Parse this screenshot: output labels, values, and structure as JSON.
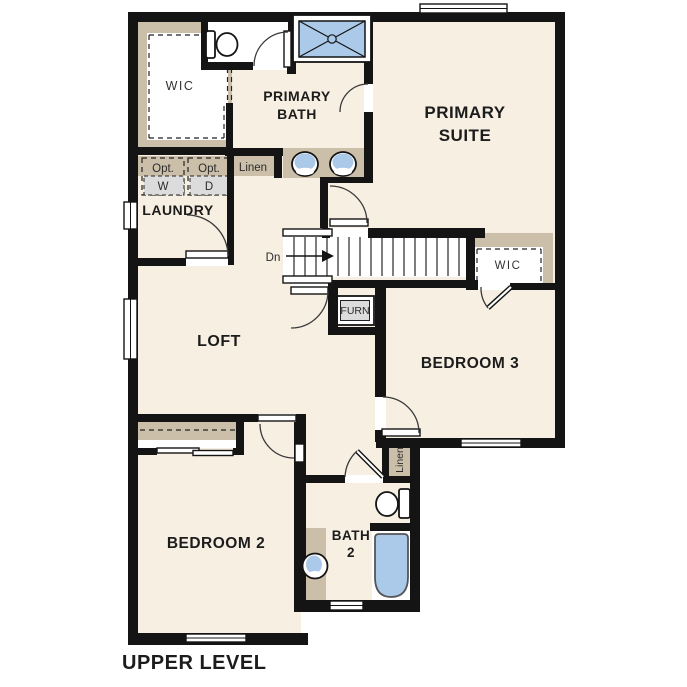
{
  "title": "UPPER LEVEL",
  "colors": {
    "wall": "#141414",
    "floor": "#f7efe2",
    "cabinet_tan": "#cbbfa9",
    "fixture_blue": "#abc9e8",
    "appliance_gray": "#dcdcdc",
    "background": "#ffffff"
  },
  "rooms": {
    "wic_left": {
      "label": "WIC"
    },
    "primary_bath": {
      "line1": "PRIMARY",
      "line2": "BATH"
    },
    "primary_suite": {
      "line1": "PRIMARY",
      "line2": "SUITE"
    },
    "laundry": {
      "label": "LAUNDRY"
    },
    "loft": {
      "label": "LOFT"
    },
    "wic_right": {
      "label": "WIC"
    },
    "bedroom3": {
      "label": "BEDROOM 3"
    },
    "bedroom2": {
      "label": "BEDROOM 2"
    },
    "bath2": {
      "line1": "BATH",
      "line2": "2"
    }
  },
  "annotations": {
    "linen_upper": "Linen",
    "linen_lower": "Linen",
    "stairs_down": "Dn",
    "furnace": "FURN",
    "opt_washer_caption": "Opt.",
    "washer": "W",
    "opt_dryer_caption": "Opt.",
    "dryer": "D"
  }
}
